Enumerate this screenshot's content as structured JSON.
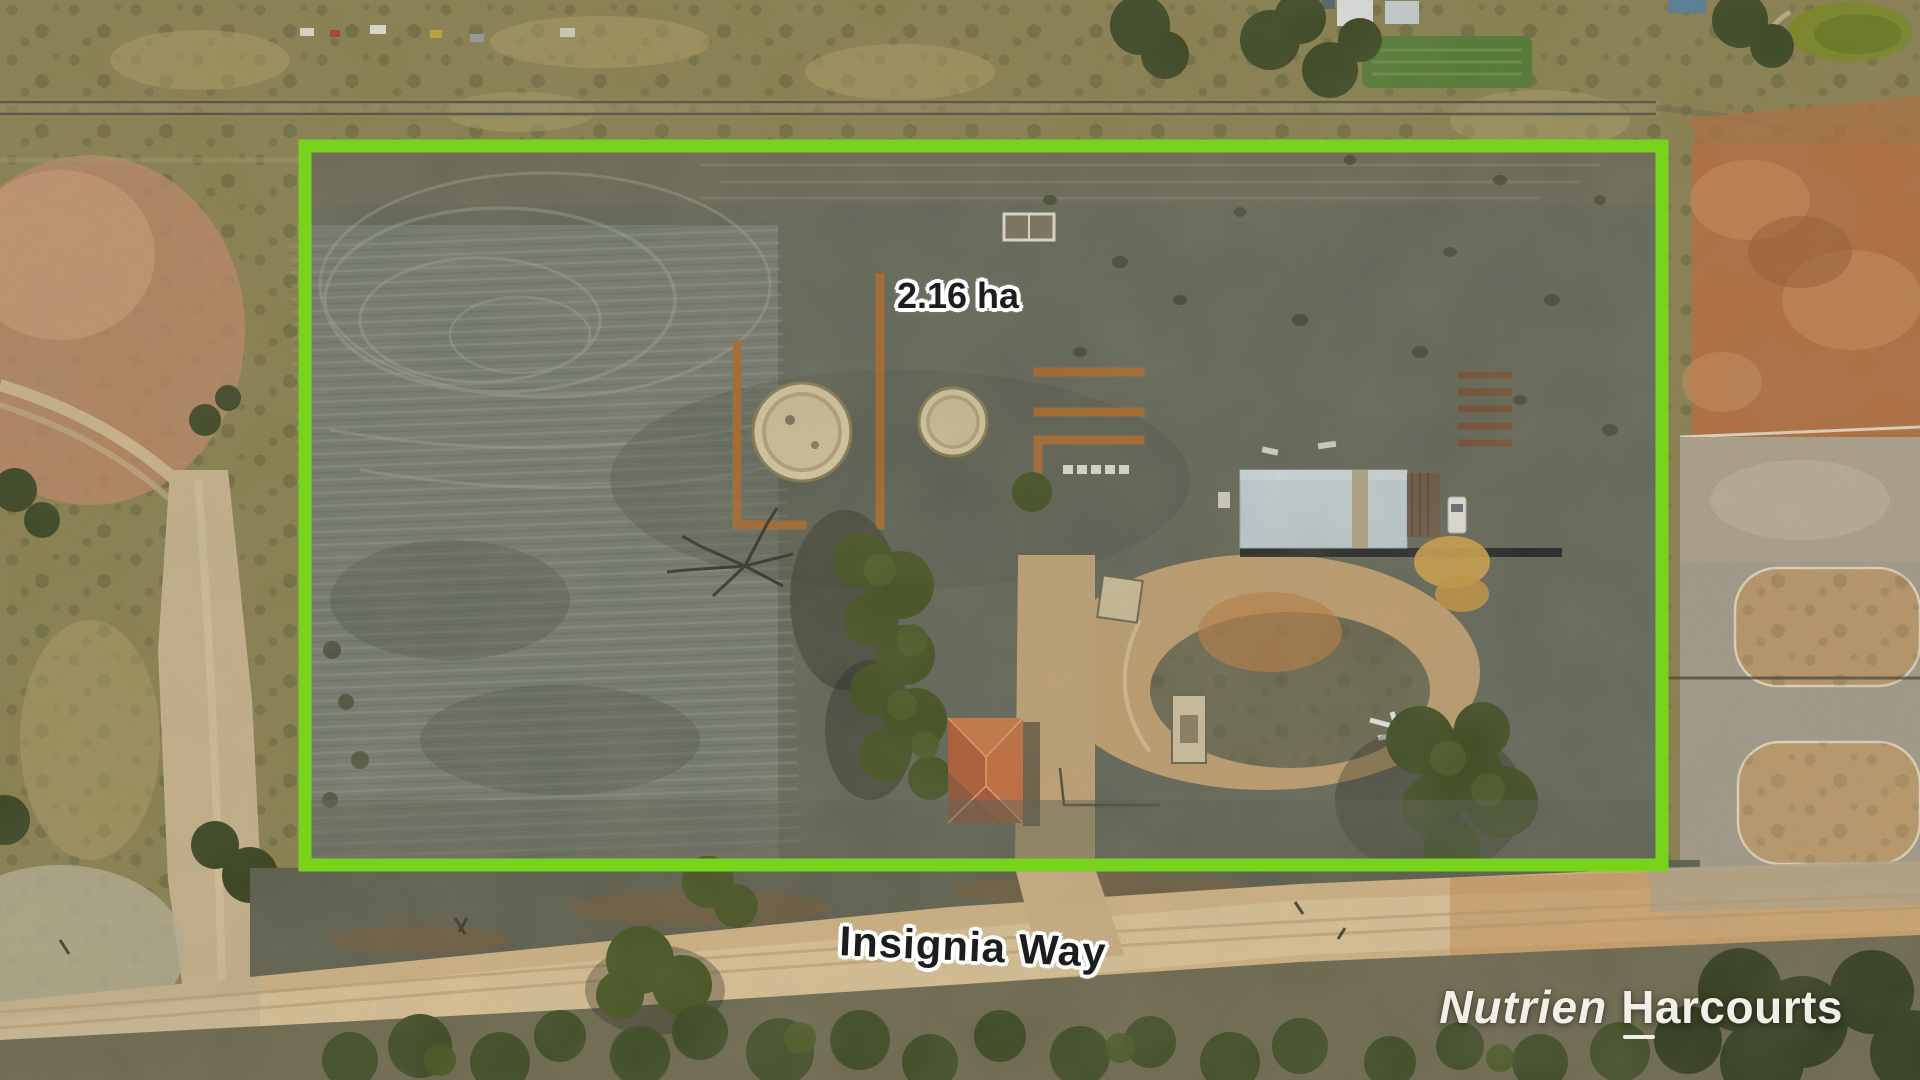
{
  "scene": {
    "description": "Aerial drone photo of a cleared rural allotment outlined in green, beside a dirt road"
  },
  "overlay": {
    "area_label": "2.16 ha",
    "road_label": "Insignia Way",
    "brand": {
      "nutrien": "Nutrien",
      "harcourts": "Harcourts"
    }
  },
  "colors": {
    "boundary_green": "#77d31c",
    "label_text": "#1d1d1b",
    "label_outline": "#ffffff",
    "brand_text": "#f2efe8"
  }
}
